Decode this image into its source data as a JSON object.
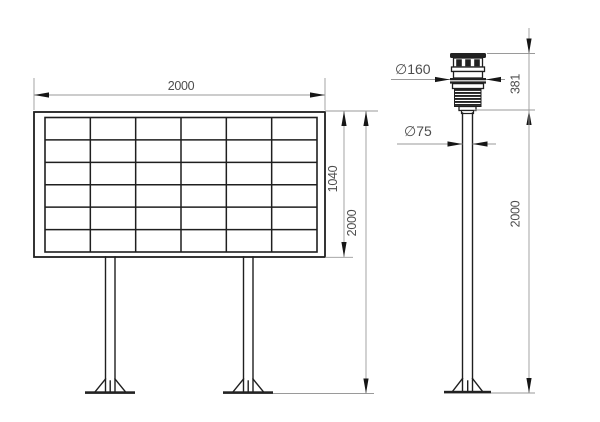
{
  "colors": {
    "background": "#ffffff",
    "line": "#1f1f1f",
    "dim_line": "#9a9a9a",
    "text": "#4d4d4d"
  },
  "front_view": {
    "width_label": "2000",
    "panel_height_label": "1040",
    "total_height_label": "2000",
    "grid": {
      "columns": 6,
      "rows": 6
    }
  },
  "side_view": {
    "sensor_diameter_label": "∅160",
    "pole_diameter_label": "∅75",
    "sensor_height_label": "381",
    "pole_height_label": "2000",
    "sensor": {
      "louver_count": 6
    }
  }
}
